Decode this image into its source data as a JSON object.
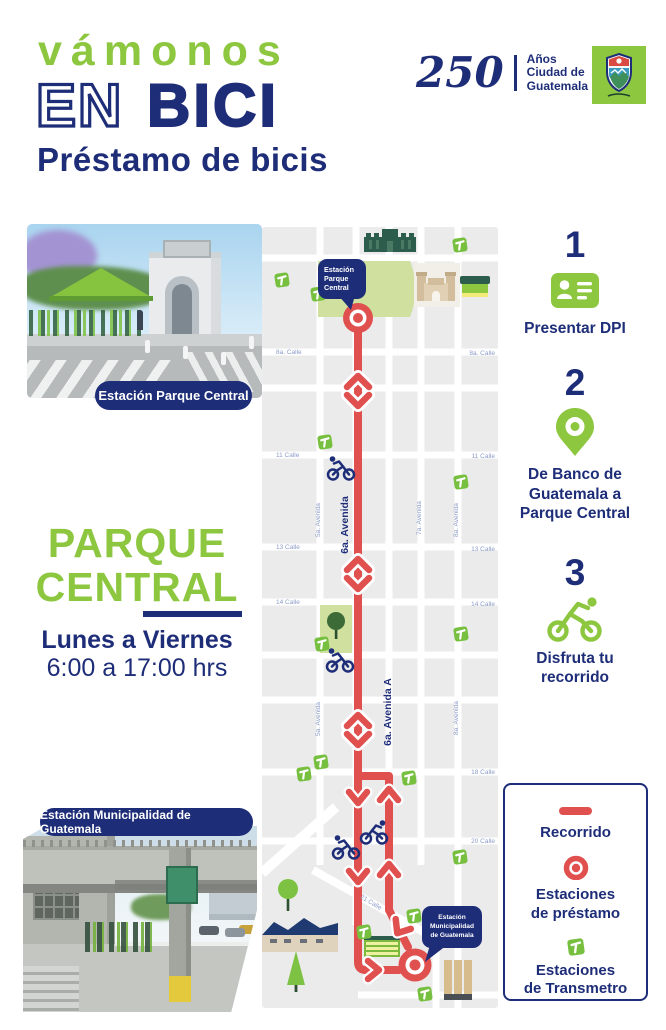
{
  "colors": {
    "green": "#8dc63f",
    "navy": "#1e2d78",
    "red": "#e0504f",
    "block_gray": "#ebebeb",
    "park_green": "#cfe09f",
    "street_label_blue": "#8b9cc7"
  },
  "header": {
    "title_top": "vámonos",
    "title_mid_outline": "EN",
    "title_mid_solid": "BICI",
    "subtitle": "Préstamo de bicis",
    "anniversary_number": "250",
    "anniversary_caption": "Años\nCiudad de\nGuatemala"
  },
  "left_column": {
    "photo_top_caption": "Estación Parque Central",
    "place_line1": "PARQUE",
    "place_line2": "CENTRAL",
    "schedule_days": "Lunes a Viernes",
    "schedule_hours": "6:00 a 17:00 hrs",
    "photo_bottom_caption": "Estación Municipalidad de Guatemala"
  },
  "steps": [
    {
      "number": "1",
      "icon": "id-card-icon",
      "label": "Presentar DPI"
    },
    {
      "number": "2",
      "icon": "location-pin-icon",
      "label": "De Banco de\nGuatemala a\nParque Central"
    },
    {
      "number": "3",
      "icon": "cyclist-icon",
      "label": "Disfruta tu\nrecorrido"
    }
  ],
  "legend": {
    "recorrido": "Recorrido",
    "prestamo": "Estaciones\nde préstamo",
    "transmetro": "Estaciones\nde Transmetro"
  },
  "map": {
    "bubble_parque": {
      "lines": [
        "Estación",
        "Parque",
        "Central"
      ]
    },
    "bubble_muni": {
      "lines": [
        "Estación",
        "Municipalidad",
        "de Guatemala"
      ]
    },
    "calle_labels": [
      {
        "text": "8a. Calle",
        "x": 18,
        "y": 129,
        "anchor": "start"
      },
      {
        "text": "8a. Calle",
        "x": 237,
        "y": 130,
        "anchor": "end"
      },
      {
        "text": "11 Calle",
        "x": 18,
        "y": 232,
        "anchor": "start"
      },
      {
        "text": "11 Calle",
        "x": 237,
        "y": 233,
        "anchor": "end"
      },
      {
        "text": "13 Calle",
        "x": 18,
        "y": 324,
        "anchor": "start"
      },
      {
        "text": "13 Calle",
        "x": 237,
        "y": 326,
        "anchor": "end"
      },
      {
        "text": "14 Calle",
        "x": 18,
        "y": 379,
        "anchor": "start"
      },
      {
        "text": "14 Calle",
        "x": 237,
        "y": 381,
        "anchor": "end"
      },
      {
        "text": "18 Calle",
        "x": 237,
        "y": 549,
        "anchor": "end"
      },
      {
        "text": "20 Calle",
        "x": 237,
        "y": 618,
        "anchor": "end"
      },
      {
        "text": "21 Calle",
        "x": 112,
        "y": 679,
        "anchor": "middle",
        "rotate": 31
      }
    ],
    "avenida_labels": [
      {
        "text": "5a. Avenida",
        "x": 62,
        "y": 295,
        "bold": false
      },
      {
        "text": "6a. Avenida",
        "x": 90,
        "y": 300,
        "bold": true
      },
      {
        "text": "7a. Avenida",
        "x": 163,
        "y": 293,
        "bold": false
      },
      {
        "text": "8a. Avenida",
        "x": 200,
        "y": 295,
        "bold": false
      },
      {
        "text": "6a. Avenida A",
        "x": 133,
        "y": 487,
        "bold": true
      },
      {
        "text": "5a. Avenida",
        "x": 62,
        "y": 494,
        "bold": false
      },
      {
        "text": "8a. Avenida",
        "x": 200,
        "y": 493,
        "bold": false
      }
    ],
    "transmetro_positions": [
      [
        195,
        13
      ],
      [
        17,
        48
      ],
      [
        53,
        62
      ],
      [
        60,
        210
      ],
      [
        196,
        250
      ],
      [
        196,
        402
      ],
      [
        57,
        412
      ],
      [
        56,
        530
      ],
      [
        39,
        542
      ],
      [
        144,
        546
      ],
      [
        195,
        625
      ],
      [
        149,
        684
      ],
      [
        99,
        700
      ],
      [
        160,
        762
      ]
    ],
    "cyclists": [
      {
        "x": 83,
        "y": 243,
        "face": "left"
      },
      {
        "x": 82,
        "y": 435,
        "face": "left"
      },
      {
        "x": 88,
        "y": 622,
        "face": "left"
      },
      {
        "x": 116,
        "y": 607,
        "face": "right"
      }
    ]
  }
}
